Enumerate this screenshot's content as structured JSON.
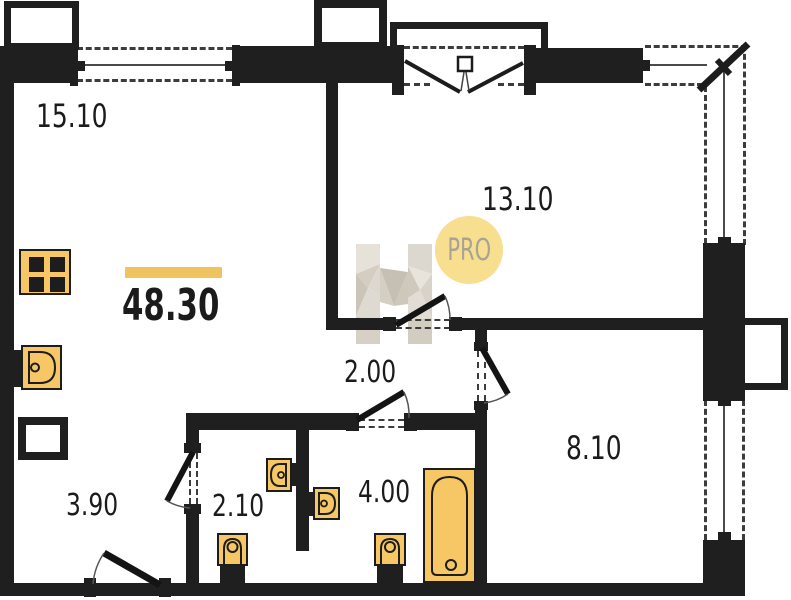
{
  "plan": {
    "total_area": {
      "value": "48.30"
    },
    "rooms": [
      {
        "name": "living-room",
        "area": "15.10"
      },
      {
        "name": "bedroom",
        "area": "13.10"
      },
      {
        "name": "hallway",
        "area": "2.00"
      },
      {
        "name": "entry",
        "area": "3.90"
      },
      {
        "name": "wc",
        "area": "2.10"
      },
      {
        "name": "bathroom",
        "area": "4.00"
      },
      {
        "name": "room-right",
        "area": "8.10"
      }
    ],
    "watermark": {
      "letter": "Н",
      "badge": "PRO"
    },
    "fixtures": {
      "stove": "stove-icon",
      "sink": "sink-icon",
      "toilet": "toilet-icon",
      "bathtub": "bathtub-icon"
    },
    "colors": {
      "wall": "#1F1F1F",
      "dash": "#3C3C3C",
      "fixture_fill": "#F6C764",
      "accent_bar": "#EFC45F",
      "badge_bg": "#F7DF8F",
      "badge_text": "#A9A395"
    }
  }
}
